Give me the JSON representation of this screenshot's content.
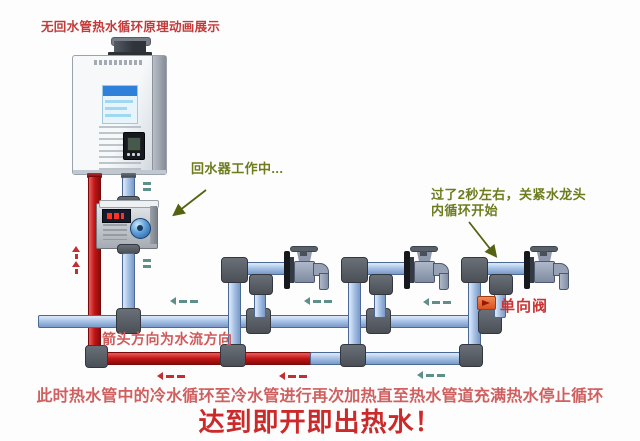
{
  "title": "无回水管热水循环原理动画展示",
  "annotations": {
    "pump_status": "回水器工作中...",
    "faucet_note_line1": "过了2秒左右，关紧水龙头",
    "faucet_note_line2": "内循环开始",
    "flow_direction_note": "箭头方向为水流方向",
    "check_valve_label": "单向阀"
  },
  "footer": {
    "line1": "此时热水管中的冷水循环至冷水管进行再次加热直至热水管道充满热水停止循环",
    "line2": "达到即开即出热水！"
  },
  "colors": {
    "title_red": "#c43a3a",
    "annotation_green": "#6e7c1e",
    "flow_note_pink": "#cf5a5a",
    "footer_pink": "#d06060",
    "footer_red": "#cc2a2a",
    "hot_pipe_red": "#c01515",
    "cold_pipe_blue": "#a9c4e8",
    "fitting_grey": "#565b62",
    "valve_orange": "#d9521f",
    "flow_arrow_teal": "#5f8f89"
  },
  "icons": {
    "water_heater": "gas-water-heater-unit",
    "circulation_pump": "return-water-pump-box",
    "faucet": "tap-with-handle",
    "check_valve": "one-way-valve-orange",
    "flow_arrow": "dashed-left-arrow",
    "pointer_arrow": "green-annotation-arrow"
  }
}
